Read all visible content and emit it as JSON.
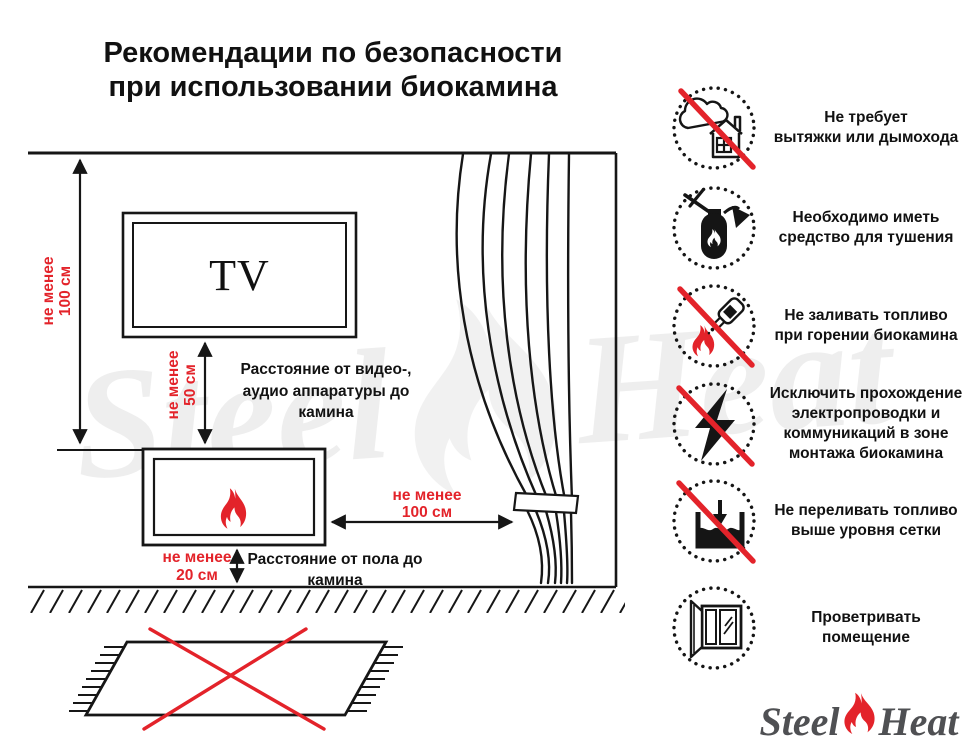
{
  "title": {
    "lines": [
      "Рекомендации по безопасности",
      "при использовании биокамина"
    ]
  },
  "diagram": {
    "tv_label": "TV",
    "wall_dim": {
      "lines": [
        "не менее",
        "100 см"
      ]
    },
    "tv_dim": {
      "lines": [
        "не менее",
        "50 см"
      ]
    },
    "tv_note": {
      "lines": [
        "Расстояние от видео-,",
        "аудио аппаратуры до",
        "камина"
      ]
    },
    "floor_dim": {
      "lines": [
        "не менее",
        "20 см"
      ]
    },
    "floor_note": {
      "lines": [
        "Расстояние от пола до",
        "камина"
      ]
    },
    "curtain_dim": {
      "lines": [
        "не менее",
        "100 см"
      ]
    }
  },
  "safety_items": [
    {
      "icon": "no-chimney-icon",
      "lines": [
        "Не требует",
        "вытяжки или дымохода"
      ]
    },
    {
      "icon": "extinguisher-icon",
      "lines": [
        "Необходимо иметь",
        "средство для тушения"
      ]
    },
    {
      "icon": "no-refuel-while-burning-icon",
      "lines": [
        "Не заливать топливо",
        "при горении биокамина"
      ]
    },
    {
      "icon": "no-wiring-icon",
      "lines": [
        "Исключить прохождение",
        "электропроводки и",
        "коммуникаций в зоне",
        "монтажа биокамина"
      ]
    },
    {
      "icon": "no-overfill-icon",
      "lines": [
        "Не переливать топливо",
        "выше уровня сетки"
      ]
    },
    {
      "icon": "ventilate-icon",
      "lines": [
        "Проветривать",
        "помещение"
      ]
    }
  ],
  "watermark": {
    "steel": "Steel",
    "heat": "Heat"
  },
  "logo": {
    "steel": "Steel",
    "heat": "Heat"
  },
  "colors": {
    "accent_red": "#e3232a",
    "line_black": "#161616",
    "logo_gray": "#4f5053"
  }
}
